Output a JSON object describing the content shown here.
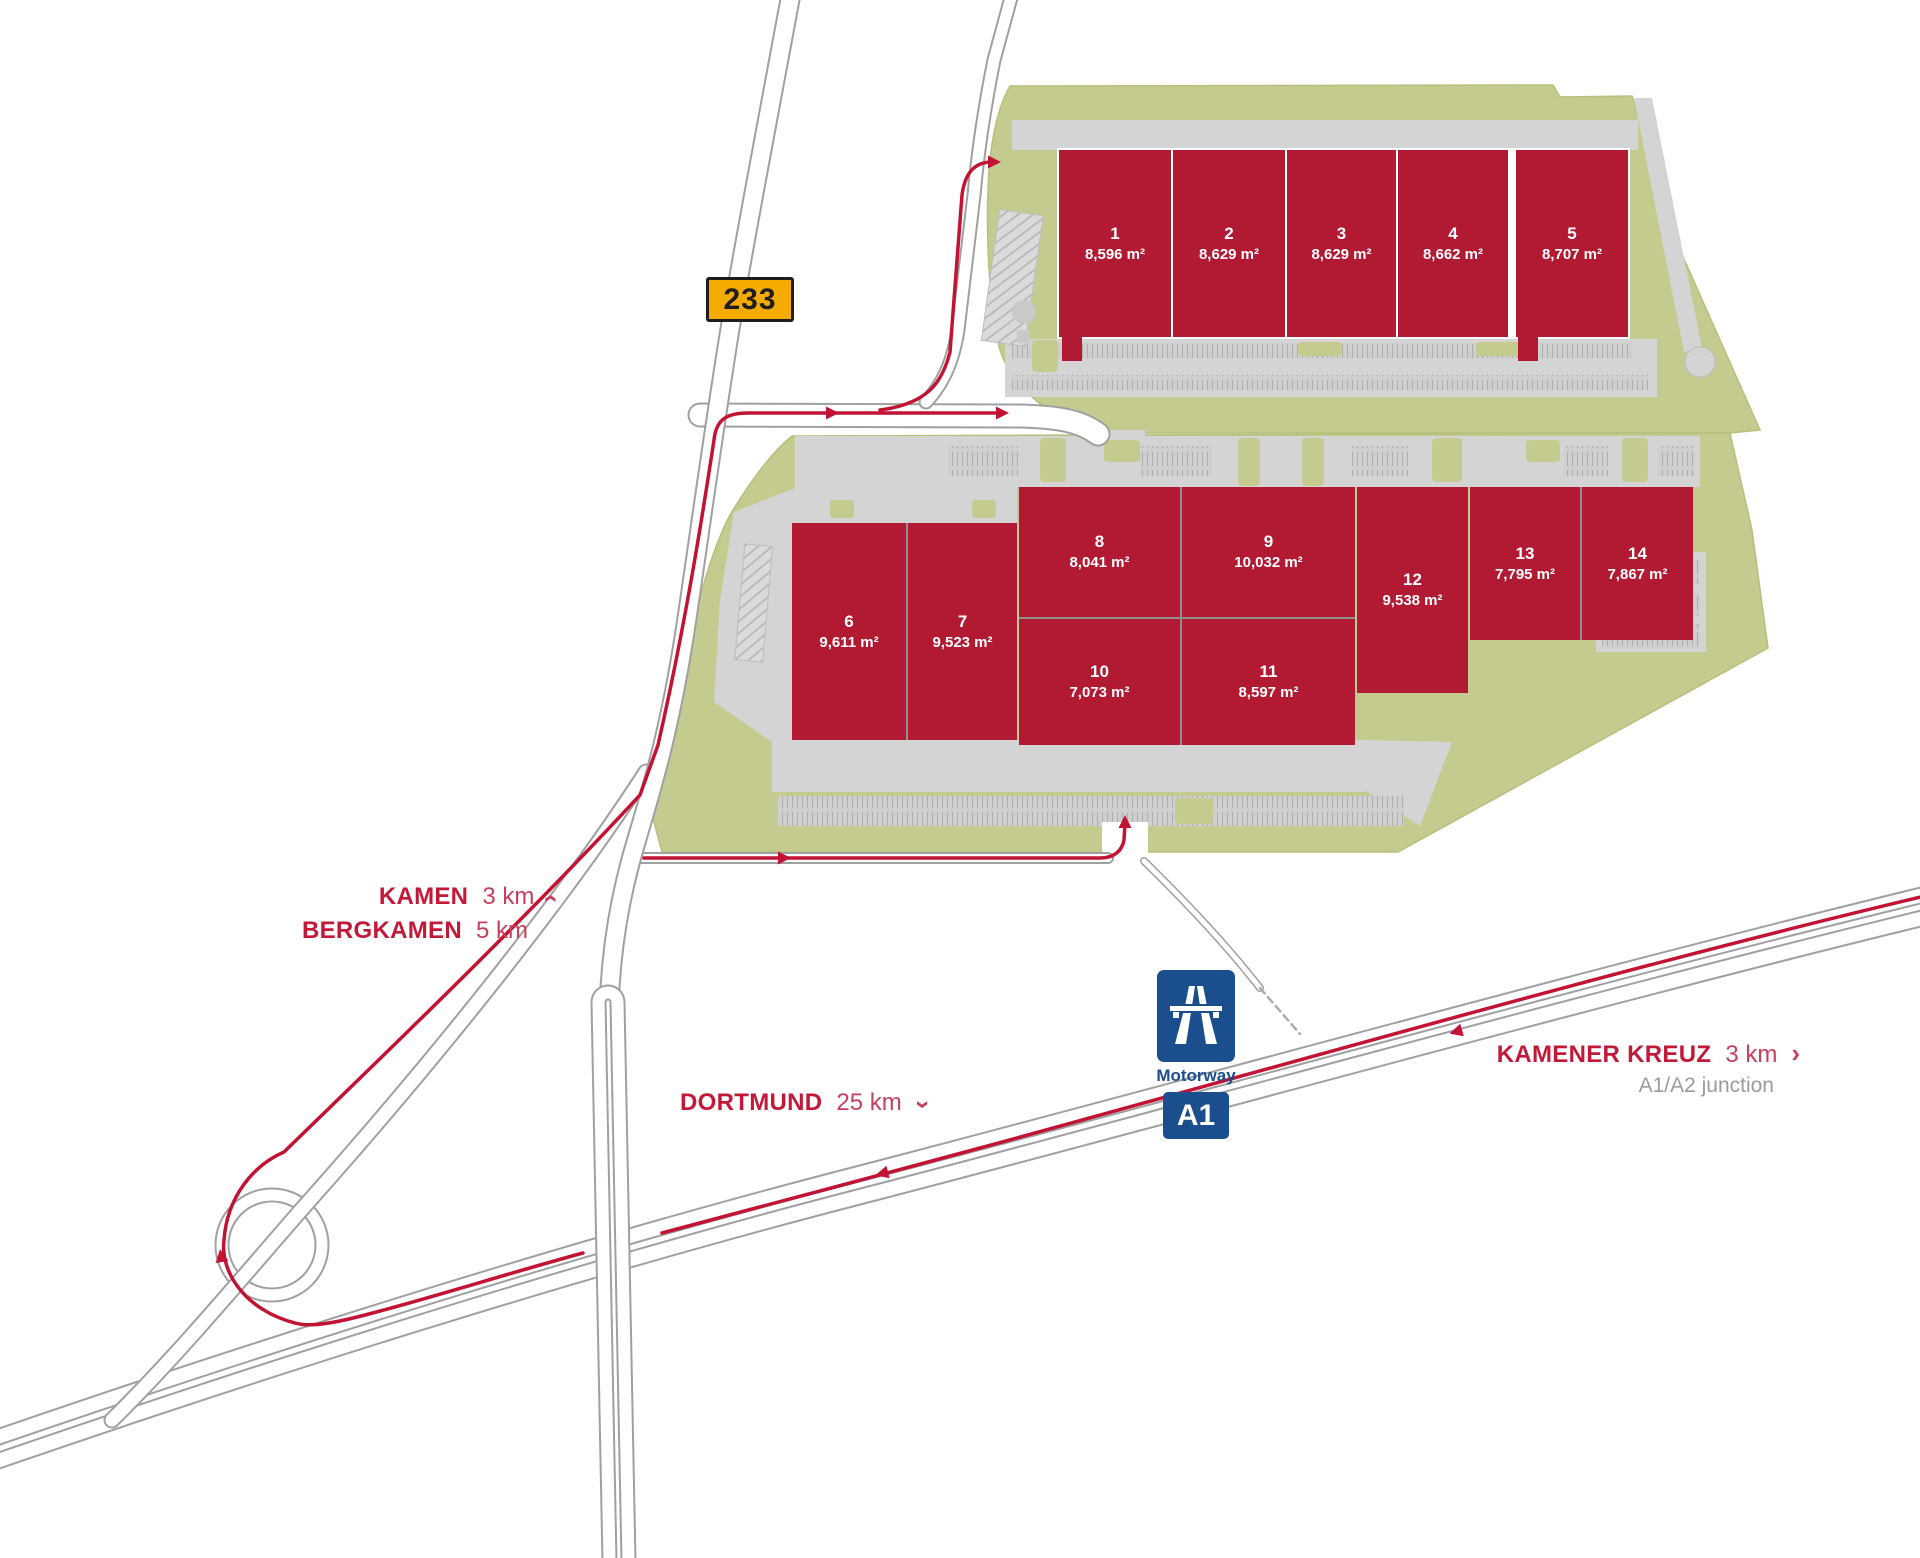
{
  "map": {
    "buildings": [
      {
        "id": "1",
        "area": "8,596 m²"
      },
      {
        "id": "2",
        "area": "8,629 m²"
      },
      {
        "id": "3",
        "area": "8,629 m²"
      },
      {
        "id": "4",
        "area": "8,662 m²"
      },
      {
        "id": "5",
        "area": "8,707 m²"
      },
      {
        "id": "6",
        "area": "9,611 m²"
      },
      {
        "id": "7",
        "area": "9,523 m²"
      },
      {
        "id": "8",
        "area": "8,041 m²"
      },
      {
        "id": "9",
        "area": "10,032 m²"
      },
      {
        "id": "10",
        "area": "7,073 m²"
      },
      {
        "id": "11",
        "area": "8,597 m²"
      },
      {
        "id": "12",
        "area": "9,538 m²"
      },
      {
        "id": "13",
        "area": "7,795 m²"
      },
      {
        "id": "14",
        "area": "7,867 m²"
      }
    ],
    "signs": {
      "route_233": "233",
      "motorway_label": "Motorway",
      "motorway_ref": "A1"
    },
    "directions": [
      {
        "name": "KAMEN",
        "distance": "3 km"
      },
      {
        "name": "BERGKAMEN",
        "distance": "5 km"
      },
      {
        "name": "DORTMUND",
        "distance": "25 km"
      },
      {
        "name": "KAMENER KREUZ",
        "distance": "3 km",
        "subtitle": "A1/A2 junction"
      }
    ],
    "icons": {
      "chevron": "›"
    },
    "colors": {
      "building": "#b21a33",
      "route": "#c31334",
      "green": "#c5cb8e",
      "road_casing": "#a0a0a0",
      "sign_233_bg": "#f6ab00",
      "motorway_blue": "#1b4e8d",
      "label_red": "#c31939",
      "label_gray": "#9b9b9b"
    }
  }
}
